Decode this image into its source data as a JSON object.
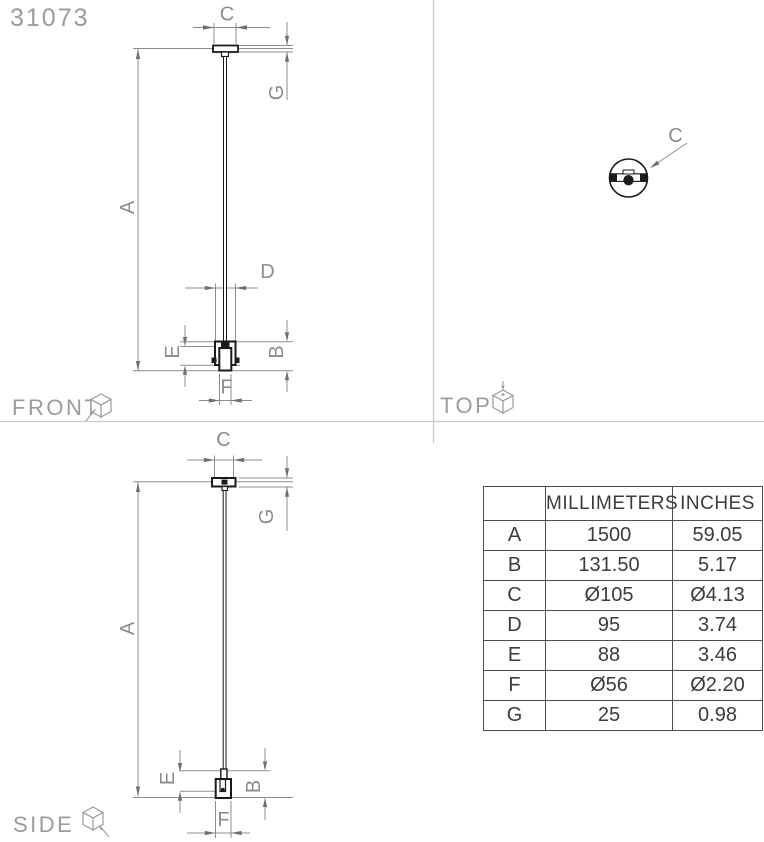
{
  "title": "31073",
  "views": {
    "front": {
      "label": "FRONT"
    },
    "top": {
      "label": "TOP"
    },
    "side": {
      "label": "SIDE"
    }
  },
  "dims": {
    "front": {
      "a": "A",
      "b": "B",
      "c": "C",
      "d": "D",
      "e": "E",
      "f": "F",
      "g": "G"
    },
    "side": {
      "a": "A",
      "b": "B",
      "c": "C",
      "e": "E",
      "f": "F",
      "g": "G"
    },
    "top": {
      "c": "C"
    }
  },
  "table": {
    "headers": {
      "label": "",
      "mm": "MILLIMETERS",
      "inches": "INCHES"
    },
    "rows": [
      {
        "key": "A",
        "mm": "1500",
        "inches": "59.05"
      },
      {
        "key": "B",
        "mm": "131.50",
        "inches": "5.17"
      },
      {
        "key": "C",
        "mm": "Ø105",
        "inches": "Ø4.13"
      },
      {
        "key": "D",
        "mm": "95",
        "inches": "3.74"
      },
      {
        "key": "E",
        "mm": "88",
        "inches": "3.46"
      },
      {
        "key": "F",
        "mm": "Ø56",
        "inches": "Ø2.20"
      },
      {
        "key": "G",
        "mm": "25",
        "inches": "0.98"
      }
    ]
  },
  "colors": {
    "fixture_line": "#1a1a1a",
    "dimension_line": "#8d8d8d",
    "dimension_text": "#8c8c8c",
    "section_label": "#9b9b9b",
    "table_border": "#4d4d4d",
    "table_text": "#3c3c3c"
  }
}
